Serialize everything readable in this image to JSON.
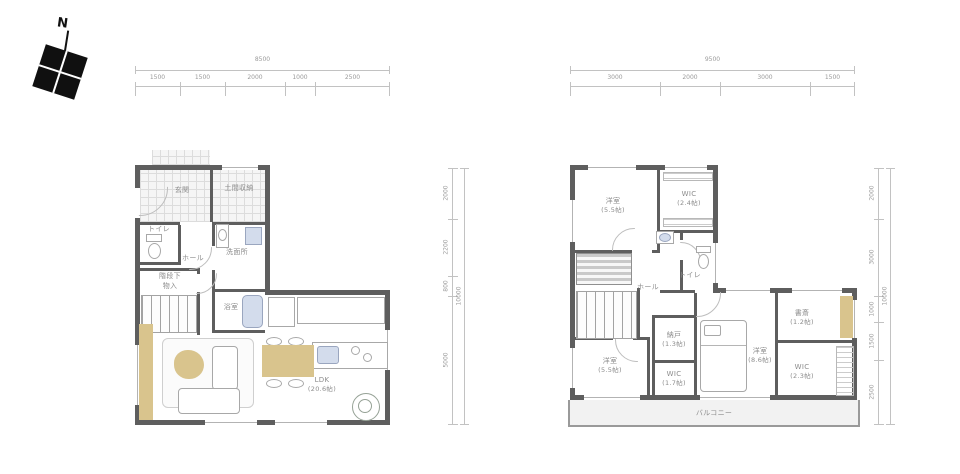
{
  "compass": {
    "north_label": "N"
  },
  "colors": {
    "wall": "#5e5e5e",
    "dim_text": "#9a9a9a",
    "room_text": "#8c8c8c",
    "accent_tan": "#d9c48d",
    "fixture_blue": "#d3dcec",
    "balcony_bg": "#f2f2f2"
  },
  "floor1": {
    "dims": {
      "top_total": "8500",
      "top_segments": [
        "1500",
        "1500",
        "2000",
        "1000",
        "2500"
      ],
      "right_total": "10000",
      "right_segments": [
        "2000",
        "2200",
        "800",
        "5000"
      ]
    },
    "rooms": {
      "genkan": {
        "label": "玄関"
      },
      "doma_storage": {
        "label": "土間収納"
      },
      "toilet": {
        "label": "トイレ"
      },
      "washroom": {
        "label": "洗面所"
      },
      "hall": {
        "label": "ホール"
      },
      "understairs_line1": "階段下",
      "understairs_line2": "物入",
      "bath": {
        "label": "浴室"
      },
      "ldk": {
        "label": "LDK",
        "size": "(20.6帖)"
      }
    }
  },
  "floor2": {
    "dims": {
      "top_total": "9500",
      "top_segments": [
        "3000",
        "2000",
        "3000",
        "1500"
      ],
      "right_total": "10000",
      "right_segments": [
        "2000",
        "3000",
        "1000",
        "1500",
        "2500"
      ]
    },
    "rooms": {
      "bedroom_nw": {
        "label": "洋室",
        "size": "(5.5帖)"
      },
      "wic_n": {
        "label": "WIC",
        "size": "(2.4帖)"
      },
      "toilet": {
        "label": "トイレ"
      },
      "hall": {
        "label": "ホール"
      },
      "storage": {
        "label": "納戸",
        "size": "(1.3帖)"
      },
      "bedroom_sw": {
        "label": "洋室",
        "size": "(5.5帖)"
      },
      "wic_s": {
        "label": "WIC",
        "size": "(1.7帖)"
      },
      "bedroom_se": {
        "label": "洋室",
        "size": "(8.6帖)"
      },
      "study": {
        "label": "書斎",
        "size": "(1.2帖)"
      },
      "wic_e": {
        "label": "WIC",
        "size": "(2.3帖)"
      },
      "balcony": {
        "label": "バルコニー"
      }
    }
  }
}
